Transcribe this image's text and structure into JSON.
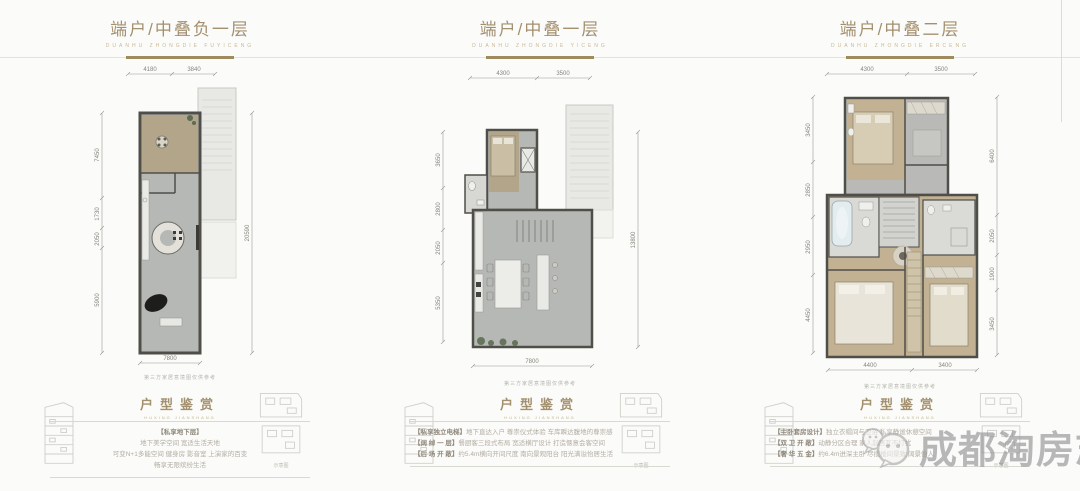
{
  "page": {
    "background": "#fbfbf9",
    "accent_gold": "#a3906f",
    "watermark_gray": "#8f8f8f"
  },
  "watermark": {
    "text": "成都淘房志",
    "logo": "wechat-bubbles-icon"
  },
  "panels": [
    {
      "title": "端户/中叠负一层",
      "subtitle": "DUANHU ZHONGDIE FUYICENG",
      "plan_caption": "第三方家居意境图仅供参考",
      "dims": {
        "top": [
          "4180",
          "3840"
        ],
        "left": [
          "7450",
          "1730",
          "2050",
          "5900"
        ],
        "right": [
          "20590"
        ],
        "bottom": [
          "7800"
        ]
      },
      "appreciation": {
        "title": "户型鉴赏",
        "subtitle": "HUXING JIANSHANG",
        "lines": [
          {
            "label": "【私享地下层】",
            "text": ""
          },
          {
            "label": "",
            "text": "地下美学空间 宽适生活天地"
          },
          {
            "label": "",
            "text": "可变N+1多能空间 健身房 影音室 上演家的百变"
          },
          {
            "label": "",
            "text": "畅享无限缤纷生活"
          }
        ]
      },
      "mini_caption": "示意图"
    },
    {
      "title": "端户/中叠一层",
      "subtitle": "DUANHU ZHONGDIE YICENG",
      "plan_caption": "第三方家居意境图仅供参考",
      "dims": {
        "top": [
          "4300",
          "3500"
        ],
        "left": [
          "3650",
          "2800",
          "2050",
          "5350"
        ],
        "right": [
          "13800"
        ],
        "bottom": [
          "7800"
        ]
      },
      "appreciation": {
        "title": "户型鉴赏",
        "subtitle": "HUXING JIANSHANG",
        "lines": [
          {
            "label": "【私享独立电梯】",
            "text": "地下直达入户 尊崇仪式体验 车库瞬达腹地的尊崇感"
          },
          {
            "label": "【阔 绰 一 层】",
            "text": "餐厨客三段式布局 宽适横厅设计 打造惬意会客空间"
          },
          {
            "label": "【后 场 开 敞】",
            "text": "约5.4m横向开间尺度 南向景观阳台 阳光满溢怡居生活"
          }
        ]
      },
      "mini_caption": "示意图"
    },
    {
      "title": "端户/中叠二层",
      "subtitle": "DUANHU ZHONGDIE ERCENG",
      "plan_caption": "第三方家居意境图仅供参考",
      "dims": {
        "top": [
          "4300",
          "3500"
        ],
        "left": [
          "3450",
          "2850",
          "2950",
          "4450"
        ],
        "right": [
          "6400",
          "2050",
          "1900",
          "3450"
        ],
        "bottom": [
          "4400",
          "3400"
        ]
      },
      "appreciation": {
        "title": "户型鉴赏",
        "subtitle": "HUXING JIANSHANG",
        "lines": [
          {
            "label": "【主卧套房设计】",
            "text": "独立衣帽间与卫浴 私享静谧休憩空间"
          },
          {
            "label": "【双 卫 开 敞】",
            "text": "动静分区合理 家人起居互不打扰"
          },
          {
            "label": "【奢 华 五 金】",
            "text": "约6.4m进深主卧 尽揽楼间景致 阔景怡人"
          }
        ]
      },
      "mini_caption": "示意图"
    }
  ]
}
